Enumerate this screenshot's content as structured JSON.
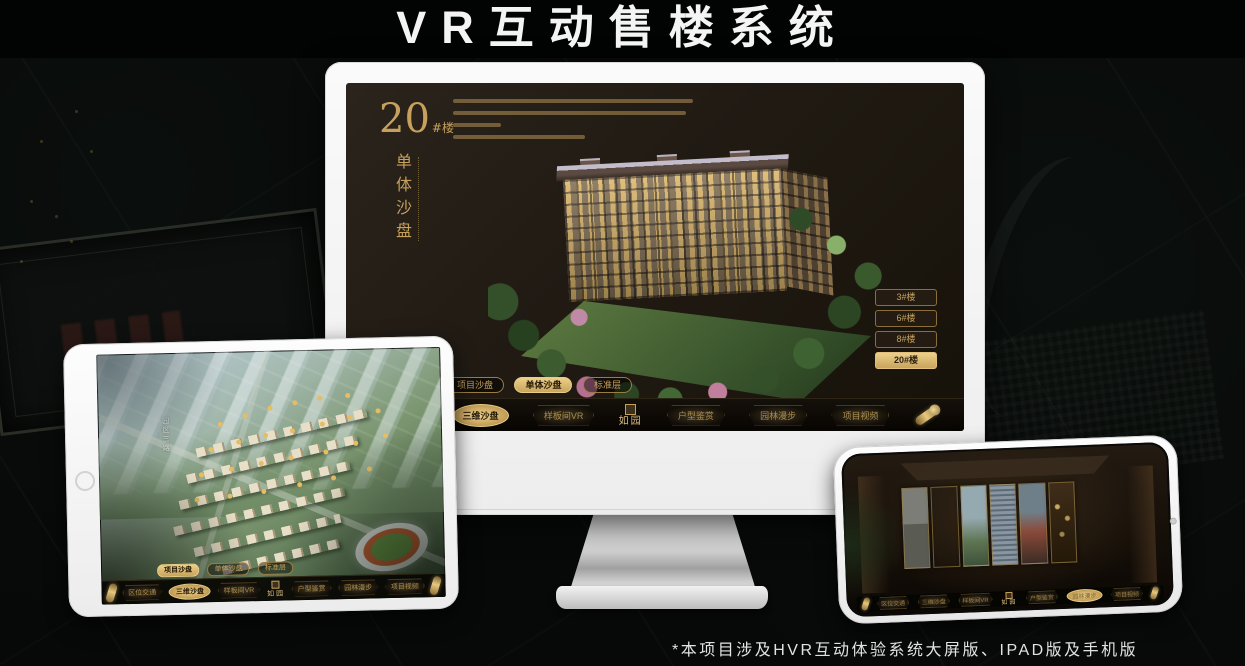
{
  "page": {
    "title": "VR互动售楼系统",
    "footnote": "*本项目涉及HVR互动体验系统大屏版、IPAD版及手机版"
  },
  "colors": {
    "accent_gold": "#c9a45c",
    "gold_bright": "#ecd08a",
    "screen_dark": "#1f1912",
    "background": "#070908",
    "device_white": "#f4f4f4",
    "badge_gold": "#e6bd63"
  },
  "nav_menu": {
    "logo": "如园",
    "items": [
      "区位交通",
      "三维沙盘",
      "样板间VR",
      "户型鉴赏",
      "园林漫步",
      "项目视频"
    ]
  },
  "sub_tabs": [
    "项目沙盘",
    "单体沙盘",
    "标准层"
  ],
  "monitor": {
    "heading_number": "20",
    "heading_suffix": "#楼",
    "vertical_title": "单体沙盘",
    "building_buttons": [
      "3#楼",
      "6#楼",
      "8#楼",
      "20#楼"
    ],
    "active_building": "20#楼",
    "active_sub_tab": "单体沙盘",
    "active_nav": "三维沙盘"
  },
  "tablet": {
    "road_label": "园区三路",
    "active_sub_tab": "项目沙盘",
    "active_nav": "三维沙盘"
  },
  "phone": {
    "active_nav": "园林漫步"
  }
}
